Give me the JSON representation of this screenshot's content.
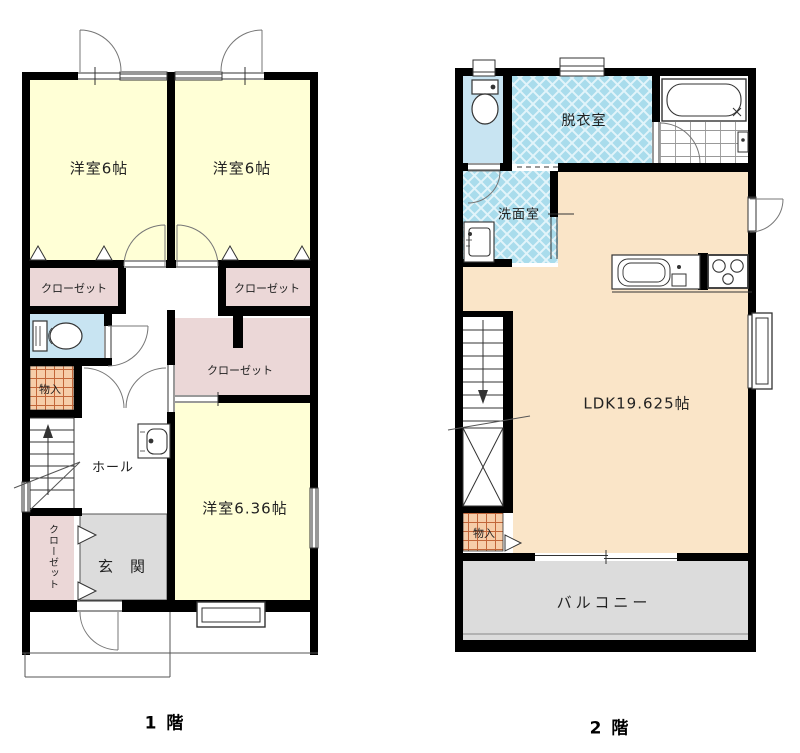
{
  "floor1": {
    "floor_label": "1 階",
    "rooms": {
      "bedroom1": "洋室6帖",
      "bedroom2": "洋室6帖",
      "bedroom3": "洋室6.36帖",
      "closet1": "クローゼット",
      "closet2": "クローゼット",
      "closet3": "クローゼット",
      "closet4": "クローゼット",
      "storage": "物入",
      "hall": "ホール",
      "entry": "玄　関"
    }
  },
  "floor2": {
    "floor_label": "2 階",
    "rooms": {
      "dressing_room": "脱衣室",
      "washroom": "洗面室",
      "ldk": "LDK19.625帖",
      "storage": "物入",
      "balcony": "バルコニー"
    }
  },
  "colors": {
    "wall": "#000000",
    "room_yellow": "#FFFFD6",
    "closet_pink": "#EBD7D7",
    "toilet_blue": "#C8E4F2",
    "wet_room_hatch": "#A9DCEC",
    "storage_orange": "#F6CDA9",
    "storage_grid_line": "#C2663A",
    "entry_gray": "#DCDCDC",
    "ldk_peach": "#FAE5C8",
    "balcony_gray": "#DCDCDC"
  }
}
